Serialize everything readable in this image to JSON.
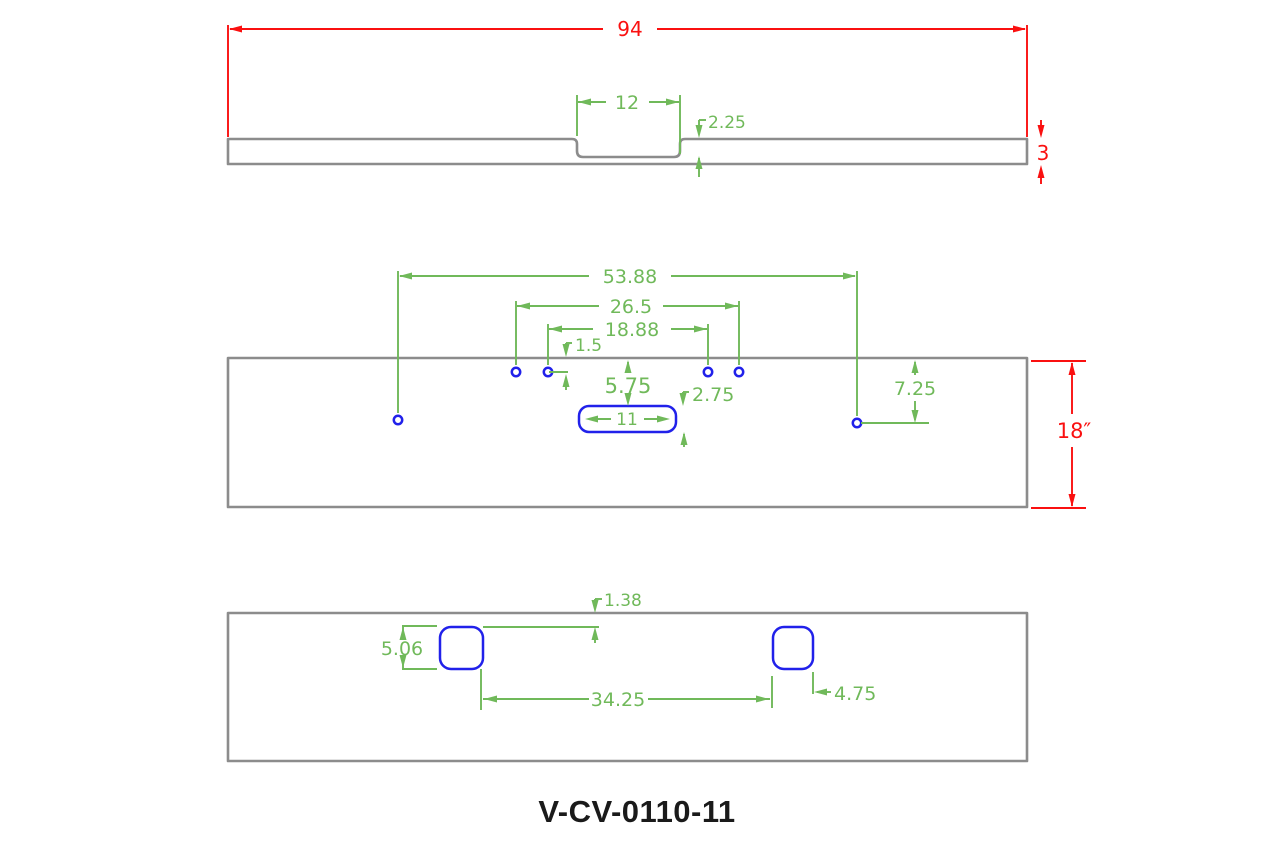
{
  "part_number": "V-CV-0110-11",
  "colors": {
    "outline_gray": "#8c8c8c",
    "dimension_red": "#fa1010",
    "dimension_green": "#70b95a",
    "feature_blue": "#2121ea"
  },
  "top_view": {
    "dims": {
      "overall_width": "94",
      "notch_width": "12",
      "notch_depth": "2.25",
      "thickness": "3"
    }
  },
  "front_view": {
    "dims": {
      "large_hole_span": "53.88",
      "outer_hole_pair_span": "26.5",
      "inner_hole_pair_span": "18.88",
      "small_holes_from_top": "1.5",
      "slot_from_top": "5.75",
      "slot_height": "2.75",
      "large_holes_from_top": "7.25",
      "slot_length": "11",
      "plate_height": "18″"
    }
  },
  "bottom_view": {
    "dims": {
      "cutout_from_top": "1.38",
      "cutout_height": "5.06",
      "cutout_spacing": "34.25",
      "cutout_edge_offset": "4.75"
    }
  }
}
